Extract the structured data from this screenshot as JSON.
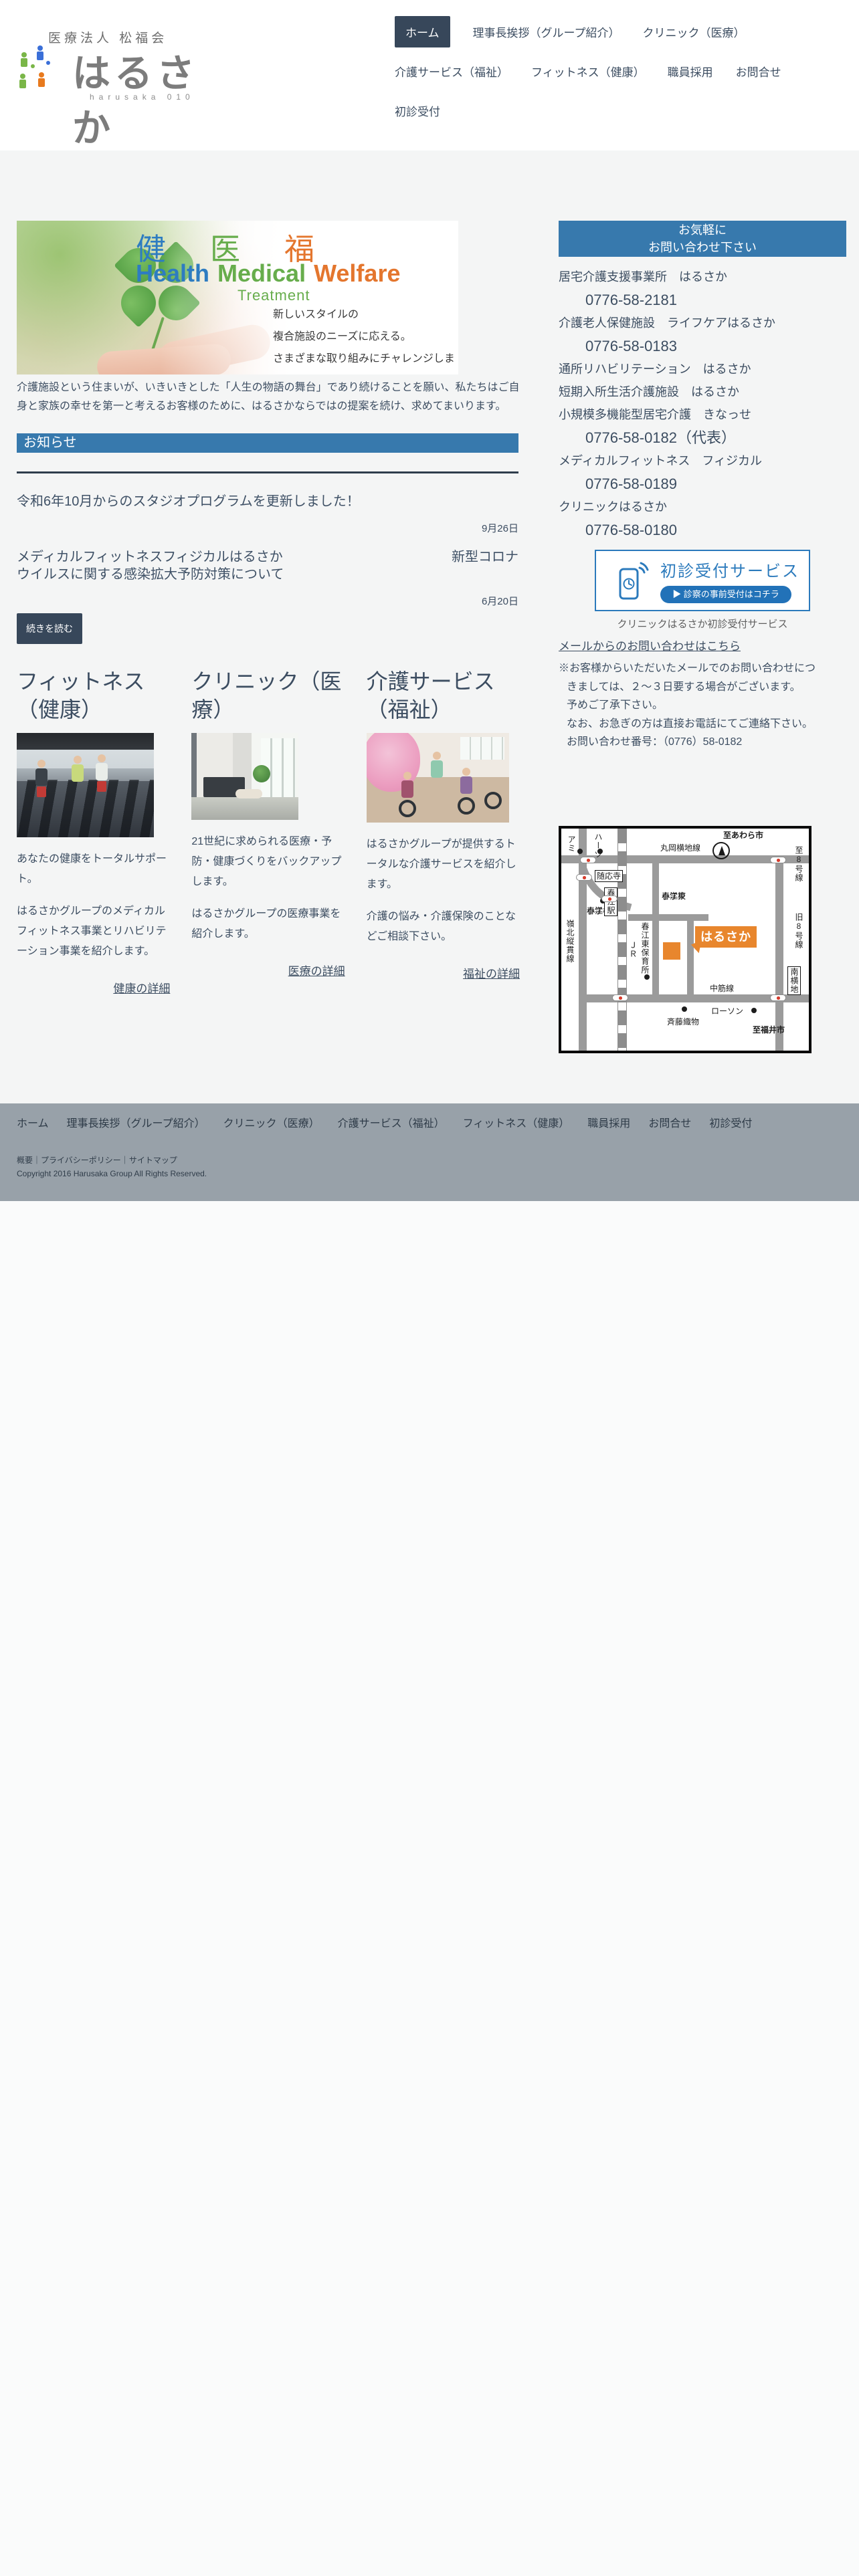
{
  "brand": {
    "corp_line": "医療法人 松福会",
    "name": "はるさか",
    "subtitle": "harusaka 010"
  },
  "nav": {
    "active_index": 0,
    "items": [
      {
        "label": "ホーム"
      },
      {
        "label": "理事長挨拶（グループ紹介）"
      },
      {
        "label": "クリニック（医療）"
      },
      {
        "label": "介護サービス（福祉）"
      },
      {
        "label": "フィットネス（健康）"
      },
      {
        "label": "職員採用"
      },
      {
        "label": "お問合せ"
      },
      {
        "label": "初診受付"
      }
    ]
  },
  "hero": {
    "kanji": [
      "健",
      "医",
      "福"
    ],
    "english": [
      "Health",
      "Medical",
      "Welfare"
    ],
    "treatment": "Treatment",
    "lines": [
      "新しいスタイルの",
      "複合施設のニーズに応える。",
      "さまざまな取り組みにチャレンジします。"
    ]
  },
  "intro": {
    "text": "介護施設という住まいが、いきいきとした「人生の物語の舞台」であり続けることを願い、私たちはご自身と家族の幸せを第一と考えるお客様のために、はるさかならではの提案を続け、求めてまいります。"
  },
  "news": {
    "heading": "お知らせ",
    "more_label": "続きを読む",
    "items": [
      {
        "title": "令和6年10月からのスタジオプログラムを更新しました！",
        "date": "9月26日"
      },
      {
        "title": "メディカルフィットネスフィジカルはるさか　新型コロナウイルスに関する感染拡大予防対策について",
        "line1_left": "メディカルフィットネスフィジカルはるさか",
        "line1_right": "新型コロナ",
        "line2": "ウイルスに関する感染拡大予防対策について",
        "date": "6月20日"
      }
    ]
  },
  "cards": [
    {
      "title": "フィットネス（健康）",
      "p1": "あなたの健康をトータルサポート。",
      "p2": "はるさかグループのメディカルフィットネス事業とリハビリテーション事業を紹介します。",
      "link": "健康の詳細"
    },
    {
      "title": "クリニック（医療）",
      "p1": "21世紀に求められる医療・予防・健康づくりをバックアップします。",
      "p2": "はるさかグループの医療事業を紹介します。",
      "link": "医療の詳細"
    },
    {
      "title": "介護サービス（福祉）",
      "p1": "はるさかグループが提供するトータルな介護サービスを紹介します。",
      "p2": "介護の悩み・介護保険のことなどご相談下さい。",
      "link": "福祉の詳細"
    }
  ],
  "contact": {
    "header_line1": "お気軽に",
    "header_line2": "お問い合わせ下さい",
    "entries": [
      {
        "name": "居宅介護支援事業所　はるさか",
        "phone": "0776-58-2181"
      },
      {
        "name": "介護老人保健施設　ライフケアはるさか",
        "phone": "0776-58-0183"
      },
      {
        "name": "通所リハビリテーション　はるさか",
        "phone": ""
      },
      {
        "name": "短期入所生活介護施設　はるさか",
        "phone": ""
      },
      {
        "name": "小規模多機能型居宅介護　きなっせ",
        "phone": "0776-58-0182（代表）"
      },
      {
        "name": "メディカルフィットネス　フィジカル",
        "phone": "0776-58-0189"
      },
      {
        "name": "クリニックはるさか",
        "phone": "0776-58-0180"
      }
    ],
    "banner": {
      "title": "初診受付サービス",
      "button": "▶ 診察の事前受付はコチラ",
      "caption": "クリニックはるさか初診受付サービス"
    },
    "mail_link": "メールからのお問い合わせはこちら",
    "note": [
      "※お客様からいただいたメールでのお問い合わせにつ",
      "きましては、２～３日要する場合がございます。",
      "予めご了承下さい。",
      "なお、お急ぎの方は直接お電話にてご連絡下さい。",
      "お問い合わせ番号：（0776）58-0182"
    ]
  },
  "map": {
    "to_awara": "至あわら市",
    "maruoka": "丸岡横地線",
    "route8": "至8号線",
    "old8": "旧8号線",
    "minami": "南横地",
    "nakasuji": "中筋線",
    "lawson": "ローソン",
    "saito": "斉藤織物",
    "to_fukui": "至福井市",
    "harusaka": "はるさか",
    "jr": "ＪＲ",
    "station": "春江駅",
    "elem1": "春江",
    "elem2": "小学校",
    "higashi1": "春江東",
    "higashi2": "小学校",
    "hoiku": "春江東保育所",
    "reihoku": "嶺北縦貫線",
    "zuioji": "随応寺",
    "ami": "アミ",
    "hearts": "ハーツ"
  },
  "footer": {
    "links": [
      "ホーム",
      "理事長挨拶（グループ紹介）",
      "クリニック（医療）",
      "介護サービス（福祉）",
      "フィットネス（健康）",
      "職員採用",
      "お問合せ",
      "初診受付"
    ],
    "sub": [
      "概要",
      "プライバシーポリシー",
      "サイトマップ"
    ],
    "sep": "｜",
    "copyright": "Copyright 2016 Harusaka Group All Rights Reserved."
  },
  "colors": {
    "accent_blue": "#3779ad",
    "dark_slate": "#37475a",
    "banner_blue": "#2b7abc",
    "orange": "#e8862d",
    "text": "#3c4d61",
    "footer_gray": "#98a1a9"
  }
}
